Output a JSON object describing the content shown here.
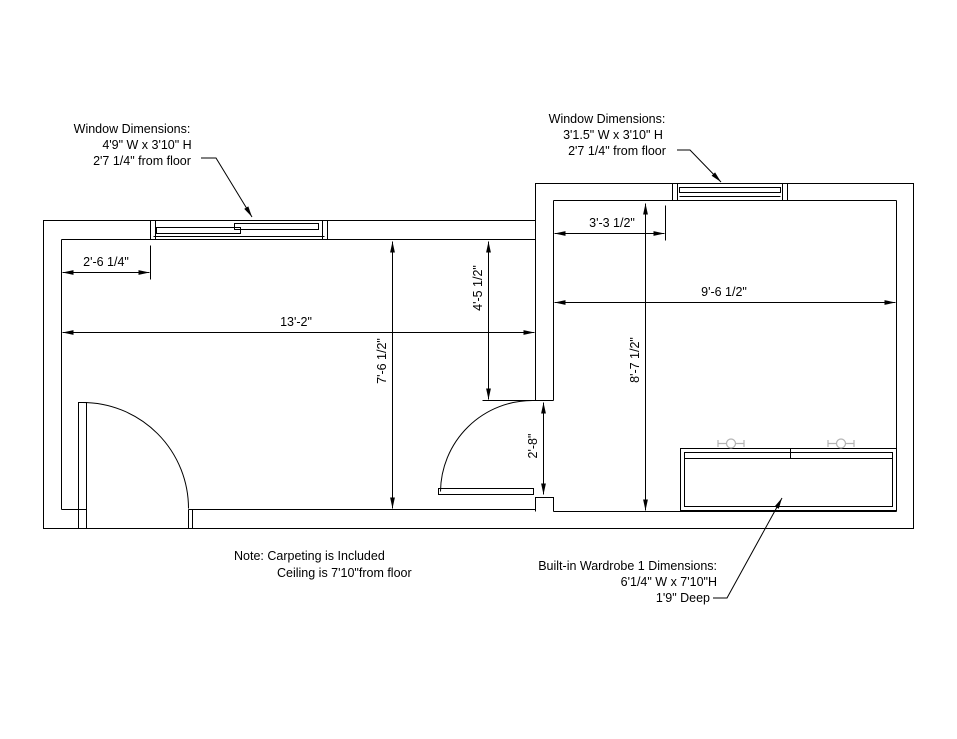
{
  "drawing": {
    "labels": {
      "window_left": {
        "title": "Window Dimensions:",
        "size": "4'9\" W x 3'10\" H",
        "height": "2'7 1/4\" from floor"
      },
      "window_right": {
        "title": "Window Dimensions:",
        "size": "3'1.5\" W x 3'10\" H",
        "height": "2'7 1/4\" from floor"
      },
      "wardrobe": {
        "title": "Built-in Wardrobe 1 Dimensions:",
        "size": "6'1/4\" W x 7'10\"H",
        "depth": "1'9\" Deep"
      },
      "note": {
        "line1": "Note: Carpeting is Included",
        "line2": "Ceiling is 7'10\"from floor"
      }
    },
    "dimensions": {
      "left_window_offset": "2'-6 1/4\"",
      "left_room_width": "13'-2\"",
      "middle_wall_upper": "4'-5 1/2\"",
      "left_room_depth": "7'-6 1/2\"",
      "right_window_offset": "3'-3 1/2\"",
      "right_room_width": "9'-6 1/2\"",
      "right_room_depth": "8'-7 1/2\"",
      "door_opening": "2'-8\""
    },
    "colors": {
      "line": "#000000",
      "background": "#ffffff",
      "symbol_gray": "#b3b3b3"
    }
  }
}
